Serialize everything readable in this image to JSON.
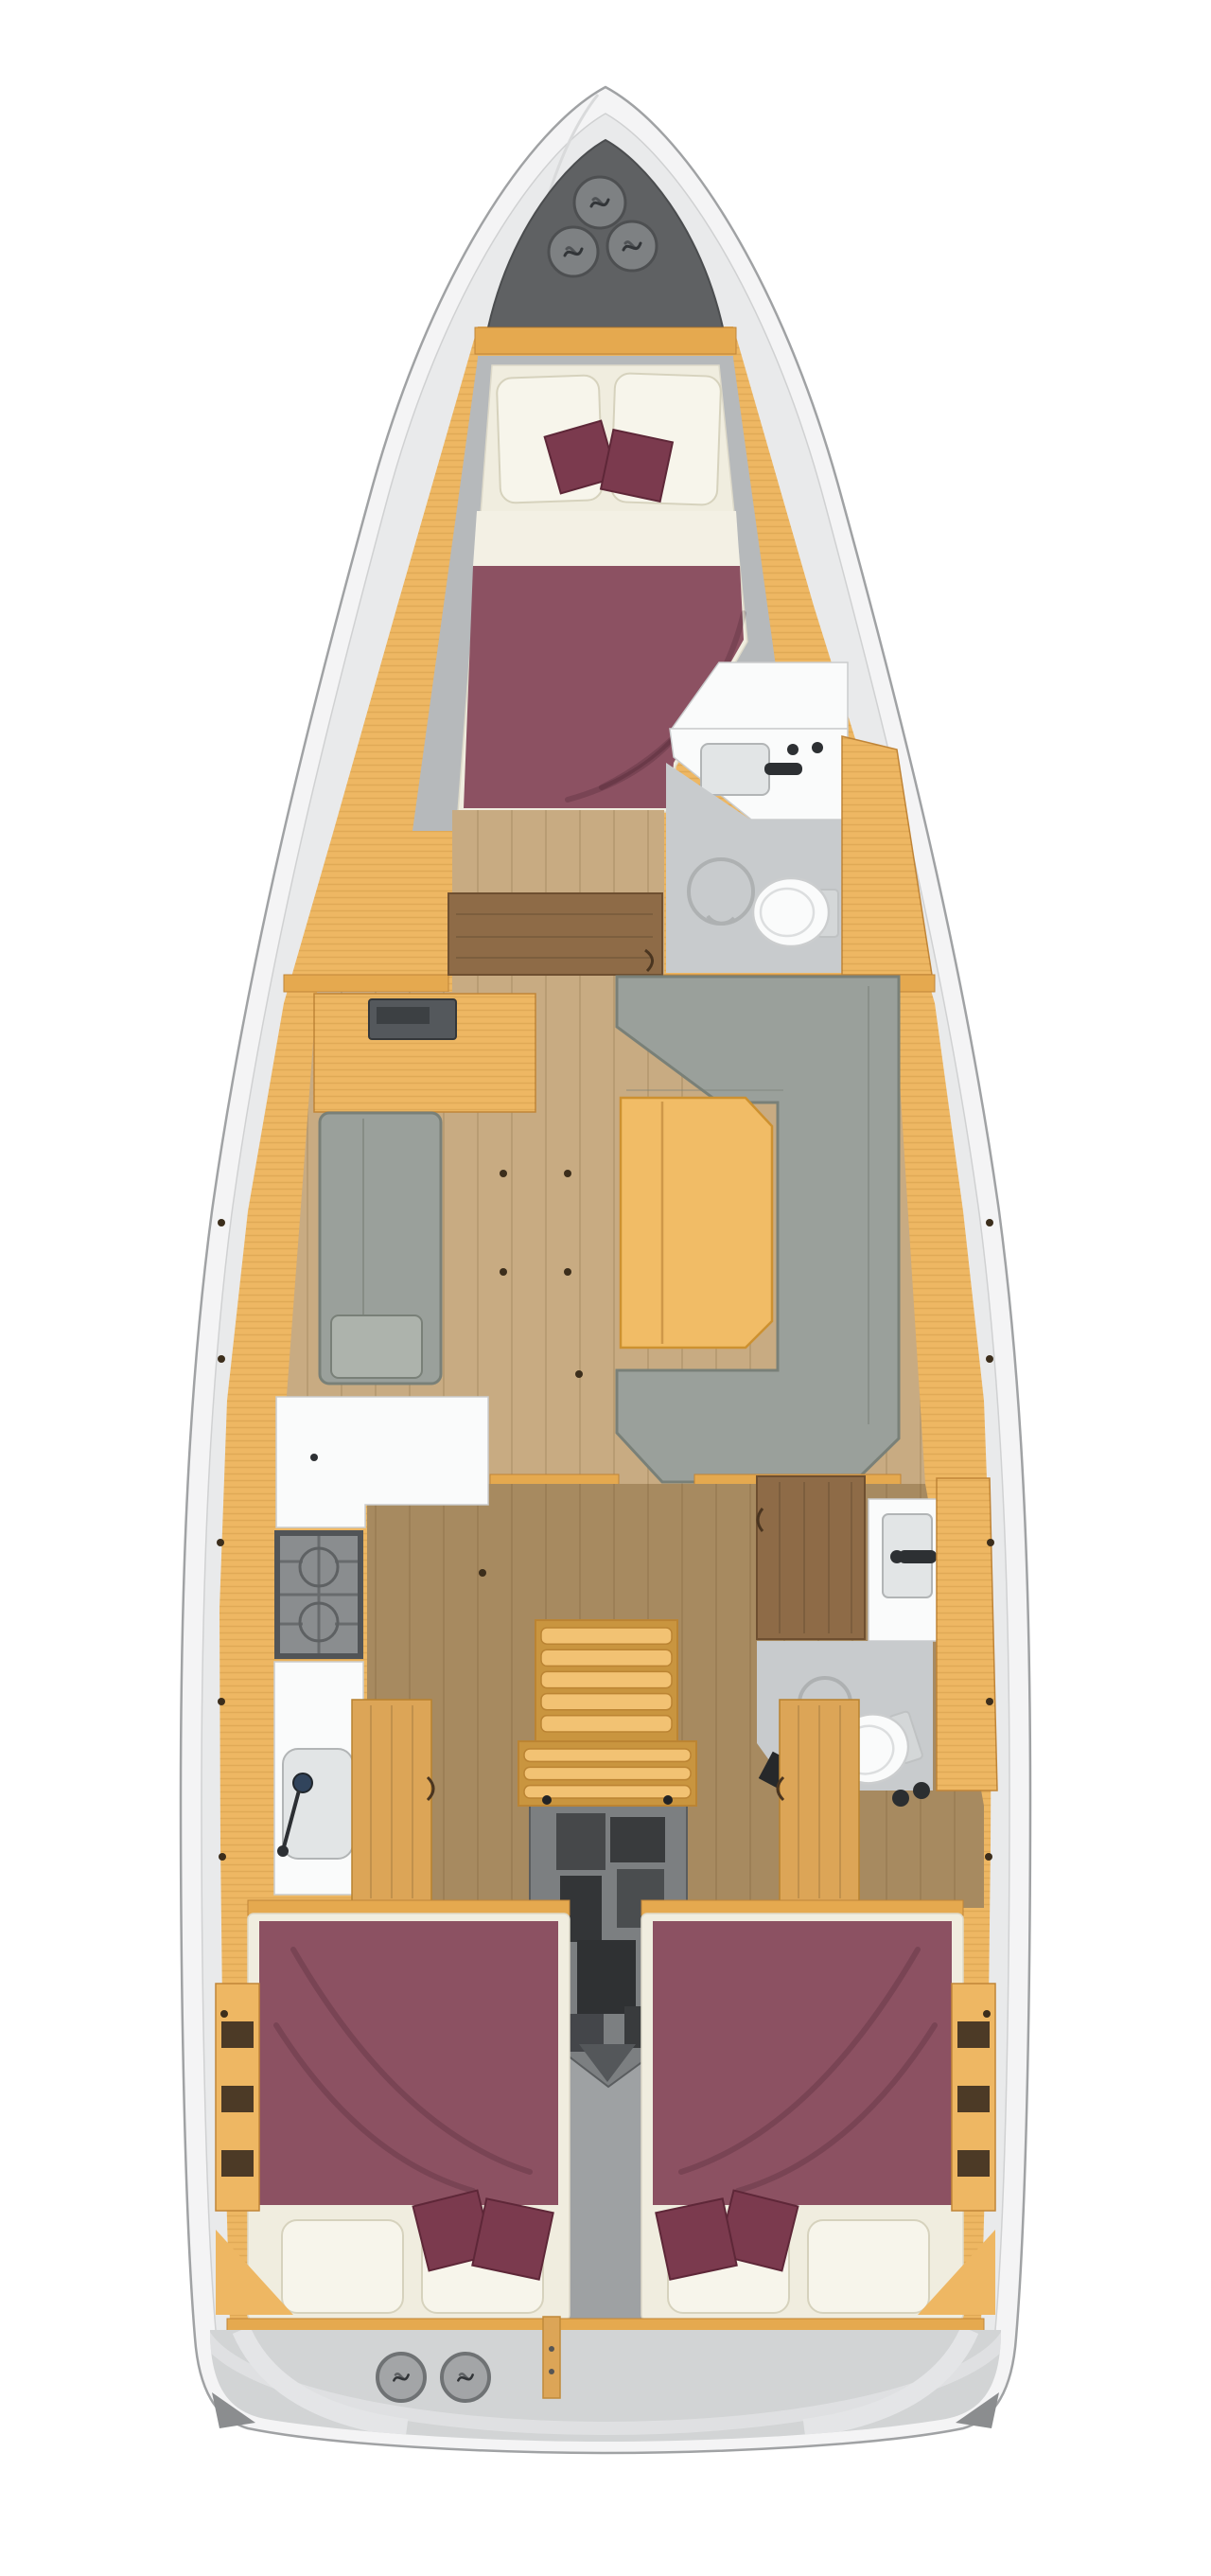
{
  "palette": {
    "page": "#ffffff",
    "hull": "#f4f4f5",
    "hull_stroke": "#a0a2a4",
    "deck": "#e9eaeb",
    "deck_stroke": "#d0d1d2",
    "wood": "#eeb763",
    "wood_edge": "#c08538",
    "trim": "#e5a94f",
    "floor_salon": "#c8ab82",
    "floor_aft": "#a78a60",
    "shelf": "#b6b9bb",
    "sofa": "#9aa09b",
    "sofa_border": "#798078",
    "sofa_light": "#adb3ac",
    "table": "#f1bc66",
    "table_edge": "#cd9130",
    "bed": "#8c5162",
    "cushion": "#7b3a4e",
    "mattress": "#f0eddf",
    "pillow": "#f7f5eb",
    "pillow_edge": "#d6d2bd",
    "bath_floor": "#c8cbcd",
    "fixture": "#fafbfb",
    "fixture_stroke": "#cbcdce",
    "sink": "#e2e5e6",
    "sink_stroke": "#b2b5b6",
    "dark": "#2d3033",
    "stove_frame": "#515457",
    "stove_top": "#8a8d8f",
    "locker": "#5f6163",
    "hatch": "#7e8183",
    "hatch_stroke": "#4d4f51",
    "glyph": "#323538",
    "engine_shell": "#7c7f81",
    "engine_dark": "#393b3d",
    "engine_mid": "#54575a",
    "stern_deck": "#d2d4d5",
    "swoosh": "#e4e5e7",
    "door_brown": "#8e6b47",
    "door_tan": "#dca557",
    "corner_dark": "#8b8d8f",
    "step": "#f2c273",
    "step_edge": "#bb8433",
    "strip": "#9ea1a3",
    "dot": "#3c2e1c"
  },
  "counts": {
    "bow_hatches": 3,
    "stern_hatches": 2,
    "stove_burners": 2,
    "upper_steps": 5,
    "lower_steps": 3,
    "port_shelf_slots": 3,
    "starboard_shelf_slots": 3,
    "forward_cabin_pillows": 2,
    "forward_cabin_cushions": 2,
    "aft_cabin_pillows_each": 2,
    "aft_cabin_cushions_each": 2,
    "cabins_total": 3,
    "heads_total": 2
  },
  "layout": {
    "view": "top-down",
    "orientation": "bow-up"
  }
}
